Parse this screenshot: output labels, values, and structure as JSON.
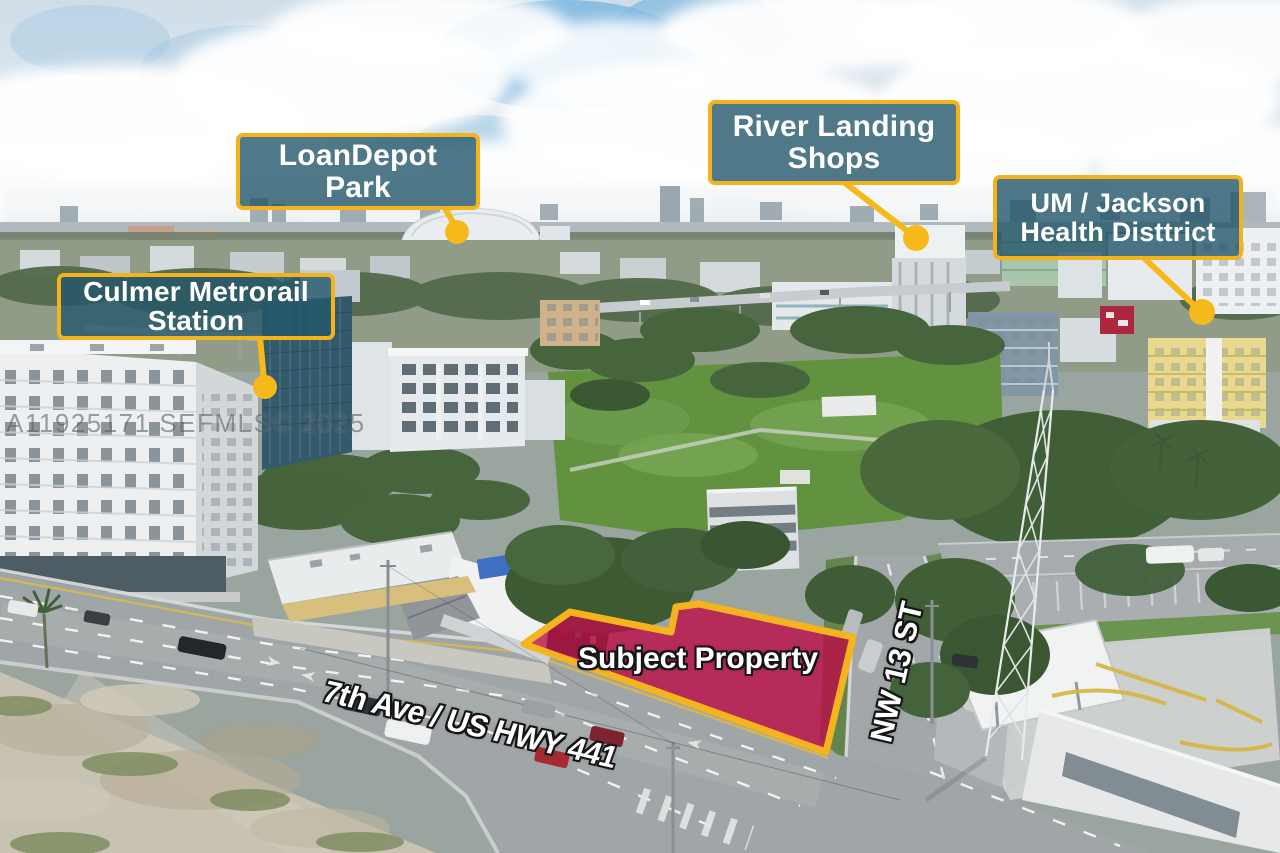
{
  "meta": {
    "description": "Aerial drone photo of subject property with location callouts",
    "watermark": "A11925171 SEFMLS© 2025"
  },
  "colors": {
    "callout_bg": "rgba(35,86,106,0.8)",
    "callout_border": "#F2B31D",
    "marker": "#F6B91B",
    "property_fill": "#BB0D48",
    "property_outline": "#F5B41D"
  },
  "callouts": [
    {
      "id": "loandepot-park",
      "lines": [
        "LoanDepot",
        "Park"
      ]
    },
    {
      "id": "river-landing-shops",
      "lines": [
        "River Landing",
        "Shops"
      ]
    },
    {
      "id": "um-jackson-health-district",
      "lines": [
        "UM / Jackson",
        "Health Disttrict"
      ]
    },
    {
      "id": "culmer-metrorail-station",
      "lines": [
        "Culmer Metrorail",
        "Station"
      ]
    }
  ],
  "property": {
    "label": "Subject Property"
  },
  "streets": {
    "main": "7th Ave / US HWY 441",
    "cross": "NW 13 ST"
  }
}
